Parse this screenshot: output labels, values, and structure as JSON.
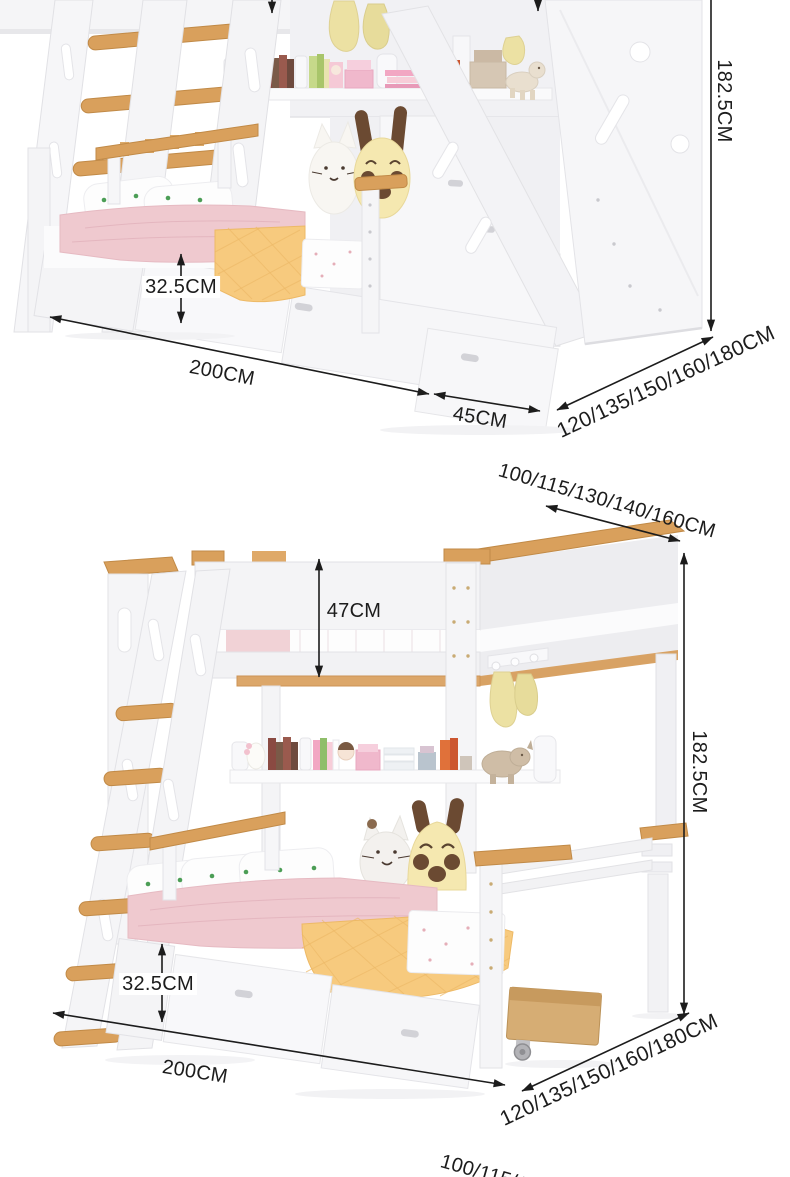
{
  "page": {
    "type": "product dimension diagram",
    "background": "#ffffff",
    "unit": "CM"
  },
  "colors": {
    "dimension_ink": "#1c1c1c",
    "wood_accent": "#d9a05c",
    "wood_dark": "#c18a47",
    "frame_white": "#f5f5f7",
    "frame_edge": "#e2e2e6",
    "pink_bedding": "#efc9cf",
    "yellow_quilt": "#f7ca7e",
    "hanging_decor_yellow": "#ece1a3"
  },
  "beds": {
    "bed_with_stairs": {
      "name": "bunk bed with storage stairs",
      "labels": {
        "total_height": "182.5CM",
        "under_bed_height": "32.5CM",
        "length": "200CM",
        "stair_depth": "45CM",
        "widths": "120/135/150/160/180CM"
      }
    },
    "bed_with_ladder": {
      "name": "bunk bed with ladder",
      "labels": {
        "upper_widths": "100/115/130/140/160CM",
        "guard_height": "47CM",
        "total_height": "182.5CM",
        "under_bed_height": "32.5CM",
        "length": "200CM",
        "widths": "120/135/150/160/180CM"
      }
    },
    "next_bed_partial": {
      "labels": {
        "upper_widths": "100/115/130/140/160CM"
      }
    }
  }
}
